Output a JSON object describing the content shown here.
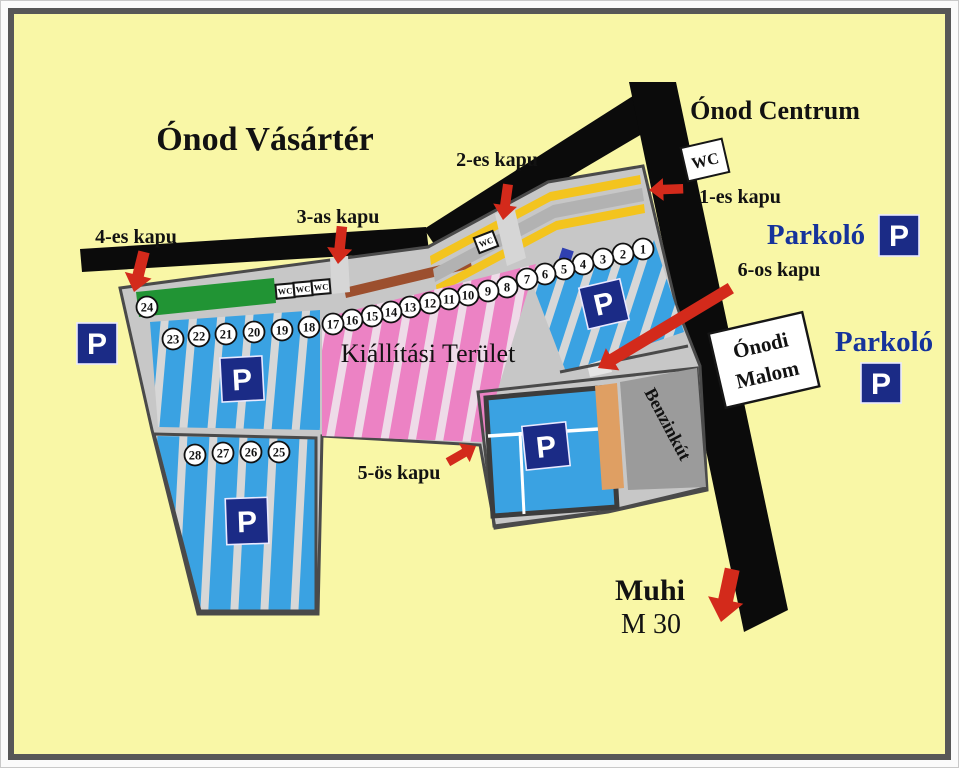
{
  "colors": {
    "bg": "#f9f7a6",
    "road": "#0b0b0b",
    "market": "#c7c7c7",
    "market-line": "#4a4a4a",
    "blue": "#3aa2e2",
    "blue-gap": "#d7d7d7",
    "pink": "#ec82c4",
    "pink-gap": "#eedbe8",
    "green": "#219434",
    "yellow": "#f3c41e",
    "brown": "#9c4f2e",
    "orange": "#df9f63",
    "benzin-gray": "#9b9b9b",
    "navy": "#1b2b86",
    "red": "#d32a1b",
    "label-blue": "#16339b"
  },
  "map": {
    "title": "Ónod Vásártér",
    "centrum": "Ónod Centrum",
    "exhibition_area": "Kiállítási Terület",
    "gates": {
      "g1": "1-es kapu",
      "g2": "2-es kapu",
      "g3": "3-as kapu",
      "g4": "4-es kapu",
      "g5": "5-ös kapu",
      "g6": "6-os kapu"
    },
    "parking_label": "Parkoló",
    "parking_symbol": "P",
    "wc": "WC",
    "mill": {
      "line1": "Ónodi",
      "line2": "Malom"
    },
    "fuel_station": "Benzinkút",
    "muhi": {
      "line1": "Muhi",
      "line2": "M 30"
    },
    "stalls": [
      {
        "n": "1",
        "x": 643,
        "y": 249
      },
      {
        "n": "2",
        "x": 623,
        "y": 254
      },
      {
        "n": "3",
        "x": 603,
        "y": 259
      },
      {
        "n": "4",
        "x": 583,
        "y": 264
      },
      {
        "n": "5",
        "x": 564,
        "y": 269
      },
      {
        "n": "6",
        "x": 545,
        "y": 274
      },
      {
        "n": "7",
        "x": 527,
        "y": 279
      },
      {
        "n": "8",
        "x": 507,
        "y": 287
      },
      {
        "n": "9",
        "x": 488,
        "y": 291
      },
      {
        "n": "10",
        "x": 468,
        "y": 295
      },
      {
        "n": "11",
        "x": 449,
        "y": 299
      },
      {
        "n": "12",
        "x": 430,
        "y": 303
      },
      {
        "n": "13",
        "x": 410,
        "y": 307
      },
      {
        "n": "14",
        "x": 391,
        "y": 312
      },
      {
        "n": "15",
        "x": 372,
        "y": 316
      },
      {
        "n": "16",
        "x": 352,
        "y": 320
      },
      {
        "n": "17",
        "x": 333,
        "y": 324
      },
      {
        "n": "18",
        "x": 309,
        "y": 327
      },
      {
        "n": "19",
        "x": 282,
        "y": 330
      },
      {
        "n": "20",
        "x": 254,
        "y": 332
      },
      {
        "n": "21",
        "x": 226,
        "y": 334
      },
      {
        "n": "22",
        "x": 199,
        "y": 336
      },
      {
        "n": "23",
        "x": 173,
        "y": 339
      },
      {
        "n": "24",
        "x": 147,
        "y": 307
      },
      {
        "n": "25",
        "x": 279,
        "y": 452
      },
      {
        "n": "26",
        "x": 251,
        "y": 452
      },
      {
        "n": "27",
        "x": 223,
        "y": 453
      },
      {
        "n": "28",
        "x": 195,
        "y": 455
      }
    ]
  }
}
